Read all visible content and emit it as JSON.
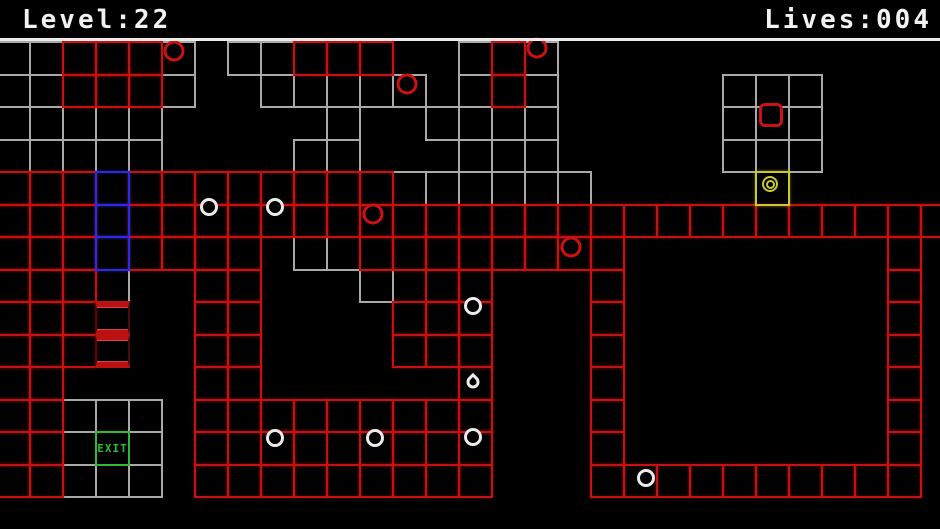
{
  "header": {
    "level_label": "Level:22",
    "lives_label": "Lives:004"
  },
  "labels": {
    "exit": "EXIT"
  },
  "palette": {
    "bg": "#000000",
    "text": "#f2f2f2",
    "white": "#ebebeb",
    "gray": "#a9a9a9",
    "gray_bright": "#c9c9c9",
    "red": "#c21212",
    "red_item": "#cc1111",
    "stripe": "#bb1111",
    "dark_red": "#4d0a0a",
    "blue": "#2b2be0",
    "yellow": "#c9c92e",
    "green": "#2fba2f"
  },
  "grid": {
    "origin_x": -4,
    "origin_y": 41,
    "cell_w": 33,
    "cell_h": 32.5,
    "cols": 29,
    "rows": 14,
    "legend": "G=gray cell, W=bright gray cell, R=red cell, B=blue cell, S=red-striped cell, E=exit cell, Y=yellow player cell, .=empty",
    "rows_map": [
      "GGRRRG.GGRRR..GRG............",
      "GGRRRG..GGGGG.GRG.....GGG....",
      "GGGGG.....G..GGGG.....GGG....",
      "GGGGG....GG...GGG.....GGG....",
      "RRRBRRRRRRRRGGGGGG.....Y.....",
      "RRRBRRRRRRRRRRRRRRRRRRRRRRRRR",
      "RRRBRRRR.GGRRRRRRRR........R.",
      "RRRG..RR...G.RR...R........R.",
      "RRRS..RR....RRR...R........R.",
      "RRRS..RR....RRR...R........R.",
      "RR....RR......R...R........R.",
      "RRGGG.RRRRRRRRR...R........R.",
      "RRGEG.RWRRWRRWR...R........R.",
      "RRGGG.RRRRRRRRR...RRRRRRRRRR."
    ]
  },
  "items": [
    {
      "kind": "red-ring",
      "x": 174,
      "y": 51
    },
    {
      "kind": "red-ring",
      "x": 537,
      "y": 48
    },
    {
      "kind": "red-ring",
      "x": 407,
      "y": 84
    },
    {
      "kind": "red-ring",
      "x": 373,
      "y": 214
    },
    {
      "kind": "red-ring",
      "x": 571,
      "y": 247
    },
    {
      "kind": "white-ring",
      "x": 209,
      "y": 207
    },
    {
      "kind": "white-ring",
      "x": 275,
      "y": 207
    },
    {
      "kind": "white-ring",
      "x": 473,
      "y": 306
    },
    {
      "kind": "white-ring",
      "x": 275,
      "y": 438
    },
    {
      "kind": "white-ring",
      "x": 375,
      "y": 438
    },
    {
      "kind": "white-ring",
      "x": 473,
      "y": 437
    },
    {
      "kind": "white-ring",
      "x": 646,
      "y": 478
    },
    {
      "kind": "droplet",
      "x": 473,
      "y": 382
    },
    {
      "kind": "red-square",
      "x": 771,
      "y": 115
    },
    {
      "kind": "yellow-target",
      "x": 770,
      "y": 184
    }
  ]
}
